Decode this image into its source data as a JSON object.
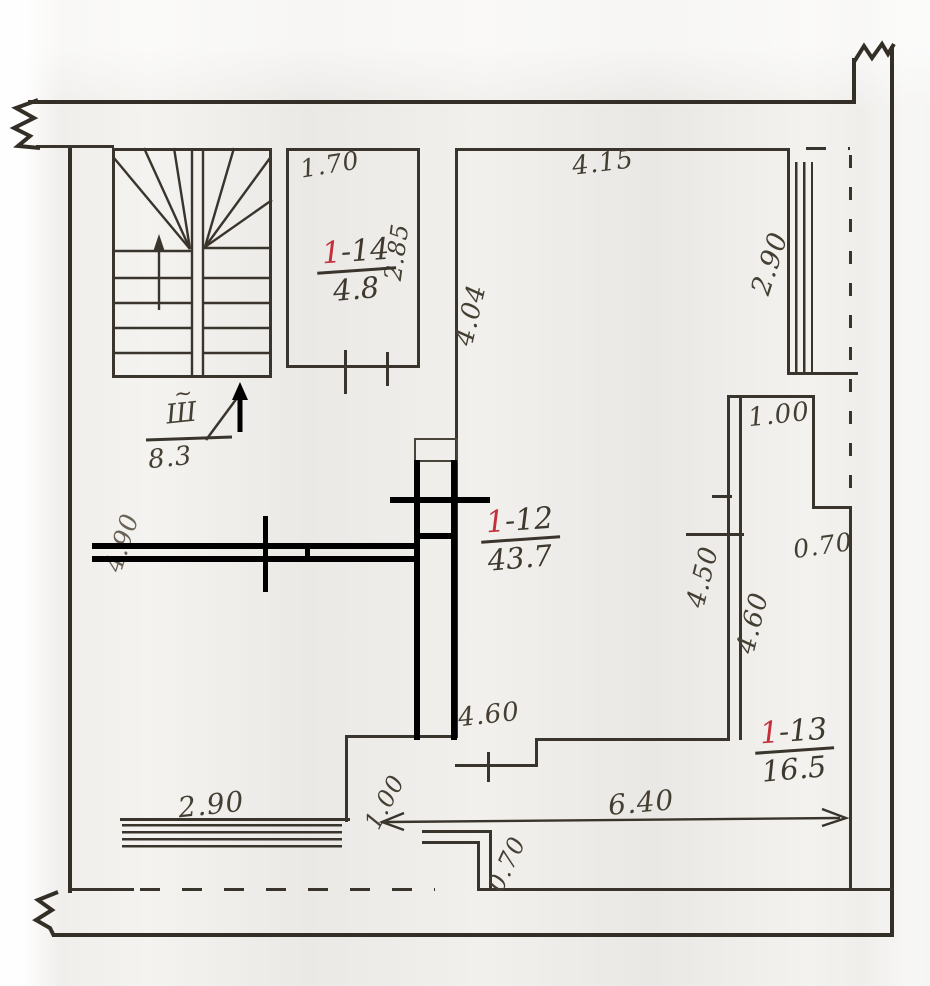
{
  "document": {
    "type": "hand-drawn apartment floor plan (scan)"
  },
  "rooms": [
    {
      "id_red": "1",
      "id_suffix": "-14",
      "area": "4.8"
    },
    {
      "id_red": "1",
      "id_suffix": "-12",
      "area": "43.7"
    },
    {
      "id_red": "1",
      "id_suffix": "-13",
      "area": "16.5"
    }
  ],
  "stairwell": {
    "designation": "Ш",
    "tilde": "~",
    "area": "8.3"
  },
  "dimensions": {
    "room14_top": "1.70",
    "room14_right": "2.85",
    "room12_top": "4.15",
    "room12_left": "4.04",
    "window_right": "2.90",
    "shaft_top": "1.00",
    "shaft_right_jog": "0.70",
    "duct_left": "4.50",
    "duct_right": "4.60",
    "room12_lower": "4.60",
    "wall_left_partial": "4.90",
    "window_bottom": "2.90",
    "bottom_step": "1.00",
    "bottom_jog": "0.70",
    "bottom_span": "6.40"
  }
}
